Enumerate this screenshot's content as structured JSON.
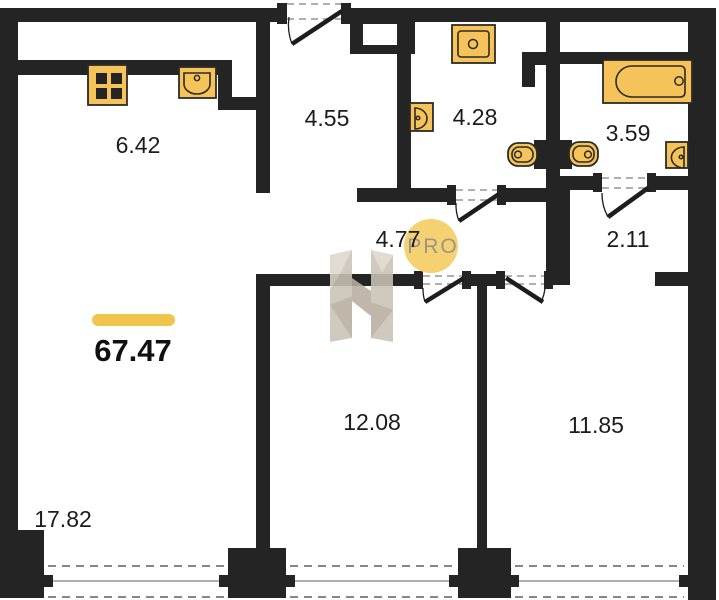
{
  "total": {
    "area": "67.47"
  },
  "rooms": {
    "kitchen": {
      "area": "6.42"
    },
    "entry_hall": {
      "area": "4.55"
    },
    "shower_room": {
      "area": "4.28"
    },
    "bathroom": {
      "area": "3.59"
    },
    "corridor": {
      "area": "4.77"
    },
    "walk_in": {
      "area": "2.11"
    },
    "room_1": {
      "area": "12.08"
    },
    "room_2": {
      "area": "11.85"
    },
    "living_room": {
      "area": "17.82"
    }
  },
  "watermark": {
    "badge_text": "PRO"
  },
  "colors": {
    "wall": "#242424",
    "fixture": "#f6c35b",
    "fixture_stroke": "#2b2b26",
    "accent": "#f0c54b",
    "pro_circle": "#f6d172",
    "pro_text": "#999588",
    "dash": "#969696",
    "window_line": "#5f5f5f",
    "label": "#1c1c1c",
    "wm_light": "#ddd7cc",
    "wm_mid": "#cac2b5",
    "wm_dark": "#b7ae9f"
  }
}
